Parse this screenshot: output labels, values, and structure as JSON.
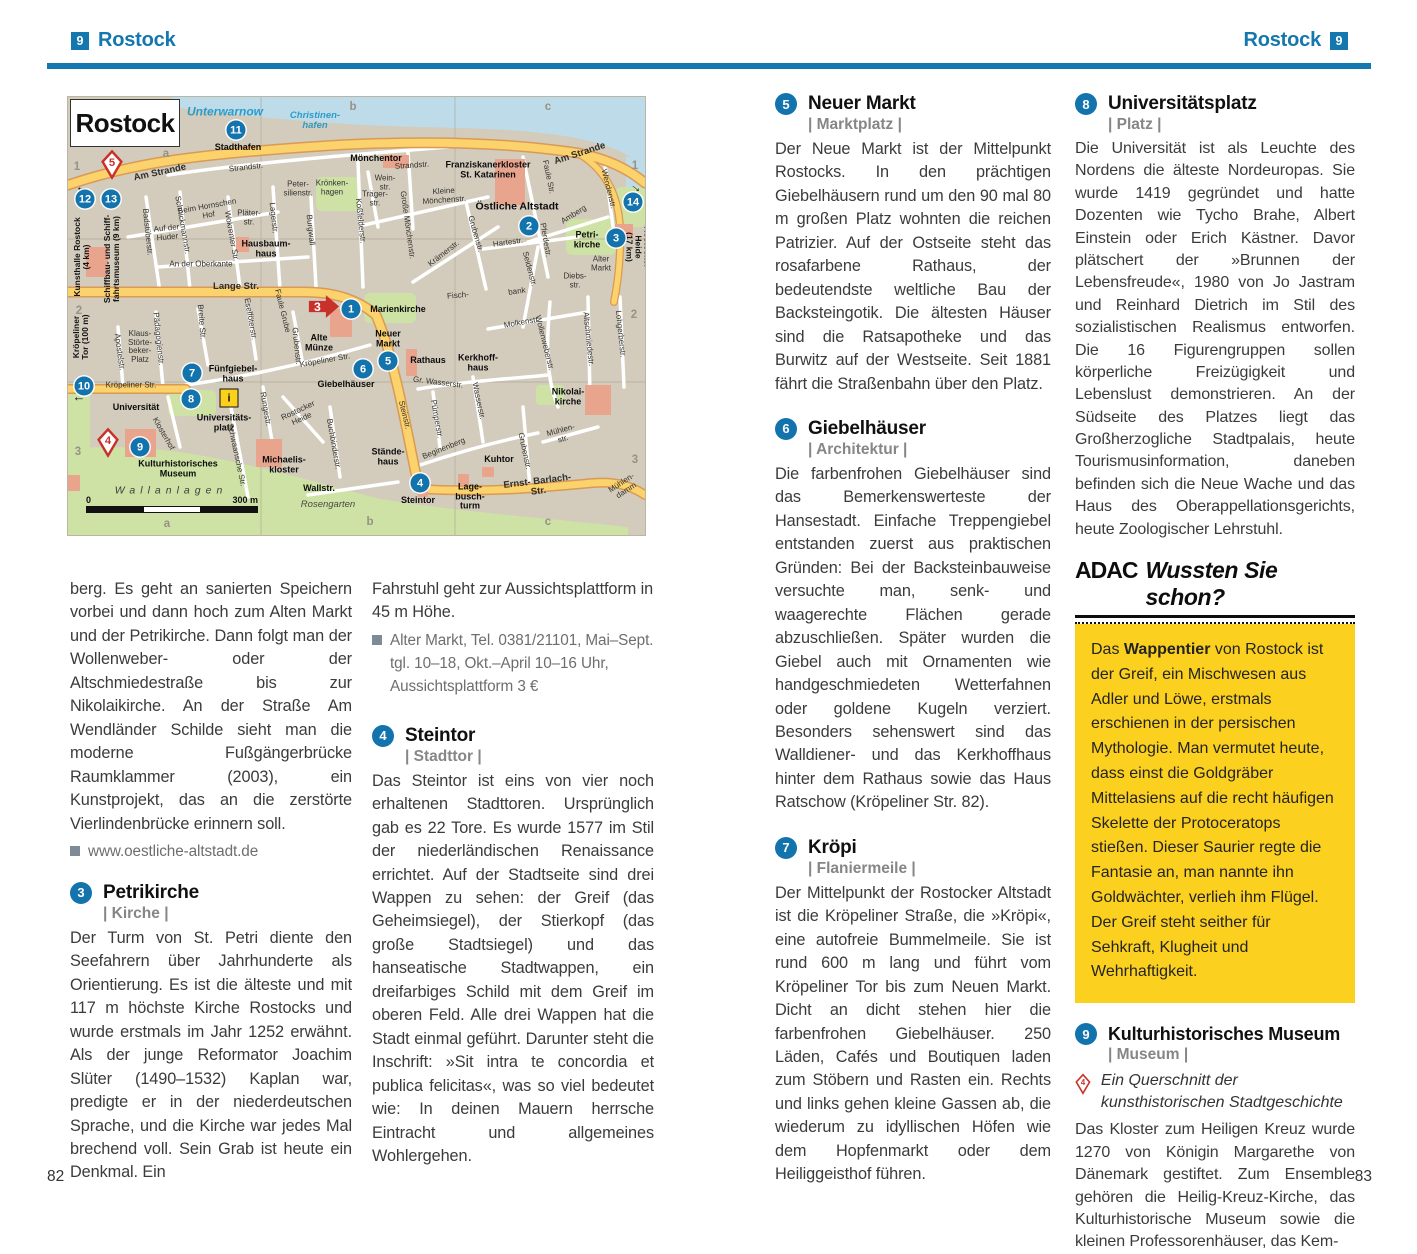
{
  "page": {
    "header_left": {
      "num": "9",
      "title": "Rostock"
    },
    "header_right": {
      "num": "9",
      "title": "Rostock"
    },
    "page_number_left": "82",
    "page_number_right": "83"
  },
  "colors": {
    "accent_blue": "#1477ae",
    "marker_blue": "#1273ad",
    "marker_red": "#c8302a",
    "adac_yellow": "#fcd01e",
    "map_bg": "#d3ccbd",
    "map_water": "#bedbe9",
    "map_green": "#cde2a4",
    "map_road": "#fbd26b",
    "map_building": "#e9a48d"
  },
  "map": {
    "title": "Rostock",
    "scale": {
      "start": "0",
      "end": "300 m"
    },
    "info_icon": {
      "x": 161,
      "y": 301
    },
    "arrow_marker": {
      "n": "3",
      "x": 256,
      "y": 212
    },
    "pins": [
      {
        "n": "5",
        "x": 44,
        "y": 70
      },
      {
        "n": "4",
        "x": 40,
        "y": 348
      }
    ],
    "markers": [
      {
        "n": "11",
        "x": 168,
        "y": 33
      },
      {
        "n": "12",
        "x": 17,
        "y": 102
      },
      {
        "n": "13",
        "x": 43,
        "y": 102
      },
      {
        "n": "14",
        "x": 565,
        "y": 105
      },
      {
        "n": "2",
        "x": 461,
        "y": 129
      },
      {
        "n": "3",
        "x": 548,
        "y": 141
      },
      {
        "n": "1",
        "x": 283,
        "y": 212
      },
      {
        "n": "5",
        "x": 320,
        "y": 264
      },
      {
        "n": "6",
        "x": 295,
        "y": 272
      },
      {
        "n": "7",
        "x": 124,
        "y": 276
      },
      {
        "n": "10",
        "x": 16,
        "y": 289
      },
      {
        "n": "8",
        "x": 123,
        "y": 302
      },
      {
        "n": "9",
        "x": 72,
        "y": 350
      },
      {
        "n": "4",
        "x": 352,
        "y": 386
      }
    ],
    "labels": [
      {
        "t": "Unterwarnow",
        "x": 157,
        "y": 15,
        "c": "wa",
        "fs": 12
      },
      {
        "t": "Christinen-\nhafen",
        "x": 247,
        "y": 24,
        "c": "wa"
      },
      {
        "t": "Stadthafen",
        "x": 170,
        "y": 51,
        "c": "pl"
      },
      {
        "t": "Am Strande",
        "x": 92,
        "y": 76,
        "r": -12,
        "c": "stb"
      },
      {
        "t": "Strandstr.",
        "x": 178,
        "y": 71,
        "r": -6,
        "c": "st"
      },
      {
        "t": "Mönchentor",
        "x": 308,
        "y": 62,
        "c": "pl"
      },
      {
        "t": "Strandstr.",
        "x": 344,
        "y": 69,
        "r": -4,
        "c": "st"
      },
      {
        "t": "Franziskanerkloster\nSt. Katarinen",
        "x": 420,
        "y": 73,
        "c": "pl"
      },
      {
        "t": "Am Strande",
        "x": 512,
        "y": 57,
        "r": -18,
        "c": "stb"
      },
      {
        "t": "Faule Str.",
        "x": 480,
        "y": 80,
        "r": 78,
        "c": "st"
      },
      {
        "t": "Peter-\nsilienstr.",
        "x": 230,
        "y": 92,
        "c": "st2"
      },
      {
        "t": "Krönken-\nhagen",
        "x": 264,
        "y": 91,
        "c": "st2"
      },
      {
        "t": "Wein-\nstr.",
        "x": 317,
        "y": 86,
        "c": "st2"
      },
      {
        "t": "Träger-\nstr.",
        "x": 307,
        "y": 102,
        "c": "st2"
      },
      {
        "t": "Kleine\nMönchenstr.",
        "x": 376,
        "y": 99,
        "r": -4,
        "c": "st2"
      },
      {
        "t": "Große Mönchenstr.",
        "x": 339,
        "y": 128,
        "r": 82,
        "c": "st"
      },
      {
        "t": "Koßfelderstr.",
        "x": 292,
        "y": 124,
        "r": 84,
        "c": "st"
      },
      {
        "t": "Östliche Altstadt",
        "x": 449,
        "y": 110,
        "c": "plb"
      },
      {
        "t": "Amberg",
        "x": 506,
        "y": 118,
        "r": -32,
        "c": "st"
      },
      {
        "t": "Wendenstr.",
        "x": 540,
        "y": 92,
        "r": 76,
        "c": "st"
      },
      {
        "t": "Rostocker Heide\n(17 km)",
        "x": 570,
        "y": 150,
        "r": 90,
        "c": "di"
      },
      {
        "t": "Petri-\nkirche",
        "x": 519,
        "y": 143,
        "c": "pl"
      },
      {
        "t": "Alter\nMarkt",
        "x": 533,
        "y": 167,
        "c": "st2"
      },
      {
        "t": "Diebs-\nstr.",
        "x": 507,
        "y": 184,
        "c": "st2"
      },
      {
        "t": "Pferdestr.",
        "x": 477,
        "y": 143,
        "r": 80,
        "c": "st"
      },
      {
        "t": "Seidenstr.",
        "x": 461,
        "y": 172,
        "r": 75,
        "c": "st"
      },
      {
        "t": "bank",
        "x": 449,
        "y": 195,
        "r": -8,
        "c": "st"
      },
      {
        "t": "Krämerstr.",
        "x": 376,
        "y": 157,
        "r": -38,
        "c": "st"
      },
      {
        "t": "Hartestr.",
        "x": 440,
        "y": 146,
        "r": -8,
        "c": "st"
      },
      {
        "t": "Grubenstr.",
        "x": 407,
        "y": 137,
        "r": 74,
        "c": "st"
      },
      {
        "t": "Fisch-",
        "x": 390,
        "y": 199,
        "r": -5,
        "c": "st"
      },
      {
        "t": "Beim Hornschen\nHof",
        "x": 140,
        "y": 114,
        "r": -10,
        "c": "st2"
      },
      {
        "t": "Auf der\nHuder",
        "x": 99,
        "y": 136,
        "r": -6,
        "c": "st2"
      },
      {
        "t": "Schnickmannstr.",
        "x": 114,
        "y": 128,
        "r": 80,
        "c": "st"
      },
      {
        "t": "Wokrenter Str.",
        "x": 163,
        "y": 139,
        "r": 80,
        "c": "st"
      },
      {
        "t": "Pläter-\nstr.",
        "x": 181,
        "y": 121,
        "c": "st2"
      },
      {
        "t": "Lagerstr.",
        "x": 205,
        "y": 121,
        "r": 84,
        "c": "st"
      },
      {
        "t": "Burgwall",
        "x": 242,
        "y": 133,
        "r": 84,
        "c": "st"
      },
      {
        "t": "Badstüberstr.",
        "x": 79,
        "y": 135,
        "r": 84,
        "c": "st"
      },
      {
        "t": "Hausbaum-\nhaus",
        "x": 198,
        "y": 152,
        "c": "pl"
      },
      {
        "t": "An der Oberkante",
        "x": 133,
        "y": 168,
        "c": "st"
      },
      {
        "t": "Lange Str.",
        "x": 168,
        "y": 190,
        "c": "stb"
      },
      {
        "t": "Kunsthalle Rostock\n(4 km)",
        "x": 14,
        "y": 160,
        "r": -90,
        "c": "di"
      },
      {
        "t": "Schiffbau- und Schiff-\nfahrtsmuseum (9 km)",
        "x": 44,
        "y": 162,
        "r": -90,
        "c": "di"
      },
      {
        "t": "Kröpeliner\nTor (100 m)",
        "x": 13,
        "y": 240,
        "r": -90,
        "c": "di"
      },
      {
        "t": "Kröpeliner Str.",
        "x": 63,
        "y": 289,
        "c": "st"
      },
      {
        "t": "Kröpeliner Str.",
        "x": 257,
        "y": 264,
        "r": -10,
        "c": "st"
      },
      {
        "t": "Apostelstr.",
        "x": 51,
        "y": 255,
        "r": 82,
        "c": "st"
      },
      {
        "t": "Klaus-\nStörte-\nbeker-\nPlatz",
        "x": 72,
        "y": 250,
        "c": "st2"
      },
      {
        "t": "Pädagogienstr.",
        "x": 90,
        "y": 242,
        "r": 84,
        "c": "st"
      },
      {
        "t": "Breite Str.",
        "x": 133,
        "y": 225,
        "r": 85,
        "c": "st"
      },
      {
        "t": "Eselföterstr.",
        "x": 182,
        "y": 222,
        "r": 80,
        "c": "st"
      },
      {
        "t": "Fünfgiebel-\nhaus",
        "x": 165,
        "y": 277,
        "c": "pl"
      },
      {
        "t": "Universität",
        "x": 68,
        "y": 311,
        "c": "pl"
      },
      {
        "t": "Universitäts-\nplatz",
        "x": 156,
        "y": 326,
        "c": "pl"
      },
      {
        "t": "Klosterhof",
        "x": 95,
        "y": 337,
        "r": 60,
        "c": "st"
      },
      {
        "t": "Schwaansche Str.",
        "x": 168,
        "y": 358,
        "r": 78,
        "c": "st"
      },
      {
        "t": "Kulturhistorisches\nMuseum",
        "x": 110,
        "y": 372,
        "c": "pl"
      },
      {
        "t": "Michaelis-\nkloster",
        "x": 216,
        "y": 368,
        "c": "pl"
      },
      {
        "t": "Wallanlagen",
        "x": 103,
        "y": 394,
        "c": "ar"
      },
      {
        "t": "Wallstr.",
        "x": 251,
        "y": 392,
        "c": "pl"
      },
      {
        "t": "Rosengarten",
        "x": 260,
        "y": 408,
        "c": "ari"
      },
      {
        "t": "Rungestr.",
        "x": 197,
        "y": 312,
        "r": 80,
        "c": "st"
      },
      {
        "t": "Rostocker\nHeide",
        "x": 232,
        "y": 318,
        "r": -25,
        "c": "st2"
      },
      {
        "t": "Buchbinderstr.",
        "x": 265,
        "y": 347,
        "r": 80,
        "c": "st"
      },
      {
        "t": "Grubenstr.",
        "x": 228,
        "y": 249,
        "r": 84,
        "c": "st"
      },
      {
        "t": "Faule Grube",
        "x": 214,
        "y": 214,
        "r": 76,
        "c": "st"
      },
      {
        "t": "Alte\nMünze",
        "x": 251,
        "y": 246,
        "c": "pl"
      },
      {
        "t": "Marienkirche",
        "x": 330,
        "y": 213,
        "c": "pl"
      },
      {
        "t": "Neuer\nMarkt",
        "x": 320,
        "y": 242,
        "c": "pl"
      },
      {
        "t": "Rathaus",
        "x": 360,
        "y": 264,
        "c": "pl"
      },
      {
        "t": "Giebelhäuser",
        "x": 278,
        "y": 288,
        "c": "pl"
      },
      {
        "t": "Gr. Wasserstr.",
        "x": 370,
        "y": 286,
        "r": 7,
        "c": "st"
      },
      {
        "t": "Steinstr.",
        "x": 336,
        "y": 318,
        "r": 76,
        "c": "st"
      },
      {
        "t": "Molkenstr.",
        "x": 454,
        "y": 226,
        "r": -10,
        "c": "st"
      },
      {
        "t": "Wollenweberstr.",
        "x": 476,
        "y": 246,
        "r": 76,
        "c": "st"
      },
      {
        "t": "Altschmiedestr.",
        "x": 520,
        "y": 242,
        "r": 84,
        "c": "st"
      },
      {
        "t": "Lohgerberstr.",
        "x": 552,
        "y": 237,
        "r": 84,
        "c": "st"
      },
      {
        "t": "Nikolai-\nkirche",
        "x": 500,
        "y": 300,
        "c": "pl"
      },
      {
        "t": "Mühlen-\nstr.",
        "x": 494,
        "y": 338,
        "r": -15,
        "c": "st2"
      },
      {
        "t": "Grubenstr.",
        "x": 456,
        "y": 354,
        "r": 78,
        "c": "st"
      },
      {
        "t": "Kerkhoff-\nhaus",
        "x": 410,
        "y": 266,
        "c": "pl"
      },
      {
        "t": "Pümperstr.",
        "x": 368,
        "y": 322,
        "r": 80,
        "c": "st"
      },
      {
        "t": "Wasserstr.",
        "x": 410,
        "y": 304,
        "r": 78,
        "c": "st"
      },
      {
        "t": "Beginenberg",
        "x": 376,
        "y": 352,
        "r": -22,
        "c": "st"
      },
      {
        "t": "Stände-\nhaus",
        "x": 320,
        "y": 360,
        "c": "pl"
      },
      {
        "t": "Steintor",
        "x": 350,
        "y": 404,
        "c": "pl"
      },
      {
        "t": "Lage-\nbusch-\nturm",
        "x": 402,
        "y": 400,
        "c": "pl"
      },
      {
        "t": "Kuhtor",
        "x": 431,
        "y": 363,
        "c": "pl"
      },
      {
        "t": "Ernst- Barlach-\nStr.",
        "x": 470,
        "y": 390,
        "r": -7,
        "c": "stb"
      },
      {
        "t": "Mühlen-\ndamm",
        "x": 556,
        "y": 390,
        "r": -33,
        "c": "st2"
      },
      {
        "t": "←",
        "x": 14,
        "y": 90,
        "c": "arw"
      },
      {
        "t": "←",
        "x": 11,
        "y": 300,
        "c": "arw"
      },
      {
        "t": "→",
        "x": 569,
        "y": 90,
        "r": 38,
        "c": "arw"
      },
      {
        "t": "a",
        "x": 98,
        "y": 57,
        "c": "gr"
      },
      {
        "t": "b",
        "x": 285,
        "y": 10,
        "c": "gr"
      },
      {
        "t": "c",
        "x": 480,
        "y": 10,
        "c": "gr"
      },
      {
        "t": "1",
        "x": 9,
        "y": 70,
        "c": "gr"
      },
      {
        "t": "2",
        "x": 11,
        "y": 214,
        "c": "gr"
      },
      {
        "t": "3",
        "x": 10,
        "y": 355,
        "c": "gr"
      },
      {
        "t": "1",
        "x": 567,
        "y": 69,
        "c": "gr"
      },
      {
        "t": "2",
        "x": 566,
        "y": 218,
        "c": "gr"
      },
      {
        "t": "3",
        "x": 567,
        "y": 363,
        "c": "gr"
      },
      {
        "t": "a",
        "x": 99,
        "y": 427,
        "c": "gr"
      },
      {
        "t": "b",
        "x": 302,
        "y": 425,
        "c": "gr"
      },
      {
        "t": "c",
        "x": 480,
        "y": 425,
        "c": "gr"
      }
    ]
  },
  "left_page": {
    "intro_continuation": "berg. Es geht an sanierten Speichern vorbei und dann hoch zum Alten Markt und der Petrikirche. Dann folgt man der Wollenweber- oder der Altschmiedestraße bis zur Nikolaikirche. An der Straße Am Wendländer Schilde sieht man die moderne Fußgängerbrücke Raumklammer (2003), ein Kunstprojekt, das an die zerstörte Vierlindenbrücke erinnern soll.",
    "intro_link": "www.oestliche-altstadt.de",
    "col2_continuation": "Fahrstuhl geht zur Aussichtsplattform in 45 m Höhe.",
    "col2_info": "Alter Markt, Tel. 0381/21101, Mai–Sept. tgl. 10–18, Okt.–April 10–16 Uhr, Aussichtsplattform 3 €"
  },
  "sections": {
    "s3": {
      "num": "3",
      "title": "Petrikirche",
      "cat": "| Kirche |",
      "body": "Der Turm von St. Petri diente den Seefahrern über Jahrhunderte als Orientierung. Es ist die älteste und mit 117 m höchste Kirche Rostocks und wurde erstmals im Jahr 1252 erwähnt. Als der junge Reformator Joachim Slüter (1490–1532) Kaplan war, predigte er in der niederdeutschen Sprache, und die Kirche war jedes Mal brechend voll. Sein Grab ist heute ein Denkmal. Ein"
    },
    "s4": {
      "num": "4",
      "title": "Steintor",
      "cat": "| Stadttor |",
      "body": "Das Steintor ist eins von vier noch erhaltenen Stadttoren. Ursprünglich gab es 22 Tore. Es wurde 1577 im Stil der niederländischen Renaissance errichtet. Auf der Stadtseite sind drei Wappen zu sehen: der Greif (das Geheimsiegel), der Stierkopf (das große Stadtsiegel) und das hanseatische Stadtwappen, ein dreifarbiges Schild mit dem Greif im oberen Feld. Alle drei Wappen hat die Stadt einmal geführt. Darunter steht die Inschrift: »Sit intra te concordia et publica felicitas«, was so viel bedeutet wie: In deinen Mauern herrsche Eintracht und allgemeines Wohlergehen."
    },
    "s5": {
      "num": "5",
      "title": "Neuer Markt",
      "cat": "| Marktplatz |",
      "body": "Der Neue Markt ist der Mittelpunkt Rostocks. In den prächtigen Giebelhäusern rund um den 90 mal 80 m großen Platz wohnten die reichen Patrizier. Auf der Ostseite steht das rosafarbene Rathaus, der bedeutendste weltliche Bau der Backsteingotik. Die ältesten Häuser sind die Ratsapotheke und das Burwitz auf der Westseite. Seit 1881 fährt die Straßenbahn über den Platz."
    },
    "s6": {
      "num": "6",
      "title": "Giebelhäuser",
      "cat": "| Architektur |",
      "body": "Die farbenfrohen Giebelhäuser sind das Bemerkenswerteste der Hansestadt. Einfache Treppengiebel entstanden zuerst aus praktischen Gründen: Bei der Backsteinbauweise versuchte man, senk- und waagerechte Flächen gerade abzuschließen. Später wurden die Giebel auch mit Ornamenten wie handgeschmiedeten Wetterfahnen oder goldene Kugeln verziert. Besonders sehenswert sind das Walldiener- und das Kerkhoffhaus hinter dem Rathaus sowie das Haus Ratschow (Kröpeliner Str. 82)."
    },
    "s7": {
      "num": "7",
      "title": "Kröpi",
      "cat": "| Flaniermeile |",
      "body": "Der Mittelpunkt der Rostocker Altstadt ist die Kröpeliner Straße, die »Kröpi«, eine autofreie Bummelmeile. Sie ist rund 600 m lang und führt vom Kröpeliner Tor bis zum Neuen Markt. Dicht an dicht stehen hier die farbenfrohen Giebelhäuser. 250 Läden, Cafés und Boutiquen laden zum Stöbern und Rasten ein. Rechts und links gehen kleine Gassen ab, die wiederum zu idyllischen Höfen wie dem Hopfenmarkt oder dem Heiliggeisthof führen."
    },
    "s8": {
      "num": "8",
      "title": "Universitätsplatz",
      "cat": "| Platz |",
      "body": "Die Universität ist als Leuchte des Nordens die älteste Nordeuropas. Sie wurde 1419 gegründet und hatte Dozenten wie Tycho Brahe, Albert Einstein oder Erich Kästner. Davor plätschert der »Brunnen der Lebensfreude«, 1980 von Jo Jastram und Reinhard Dietrich im Stil des sozialistischen Realismus entworfen. Die 16 Figurengruppen sollen körperliche Freizügigkeit und Lebenslust demonstrieren. An der Südseite des Platzes liegt das Großherzogliche Stadtpalais, heute Tourismusinformation, daneben befinden sich die Neue Wache und das Haus des Oberappellationsgerichts, heute Zoologischer Lehrstuhl."
    },
    "s9": {
      "num": "9",
      "title": "Kulturhistorisches Museum",
      "cat": "| Museum |",
      "pin": "4",
      "lead": "Ein Querschnitt der kunsthistorischen Stadtgeschichte",
      "body": "Das Kloster zum Heiligen Kreuz wurde 1270 von Königin Margarethe von Dänemark gestiftet. Zum Ensemble gehören die Heilig-Kreuz-Kirche, das Kulturhistorische Museum sowie die kleinen Professorenhäuser, das Kem-"
    }
  },
  "adac": {
    "brand": "ADAC",
    "title": "Wussten Sie schon?",
    "p1": "Das ",
    "bold": "Wappentier",
    "p2": " von Rostock ist der Greif, ein Mischwesen aus Adler und Löwe, erstmals erschienen in der persischen Mythologie. Man vermutet heute, dass einst die Goldgräber Mittelasiens auf die recht häufigen Skelette der Protoceratops stießen. Dieser Saurier regte die Fantasie an, man nannte ihn Goldwächter, verlieh ihm Flügel. Der Greif steht seither für Sehkraft, Klugheit und Wehrhaftigkeit."
  }
}
